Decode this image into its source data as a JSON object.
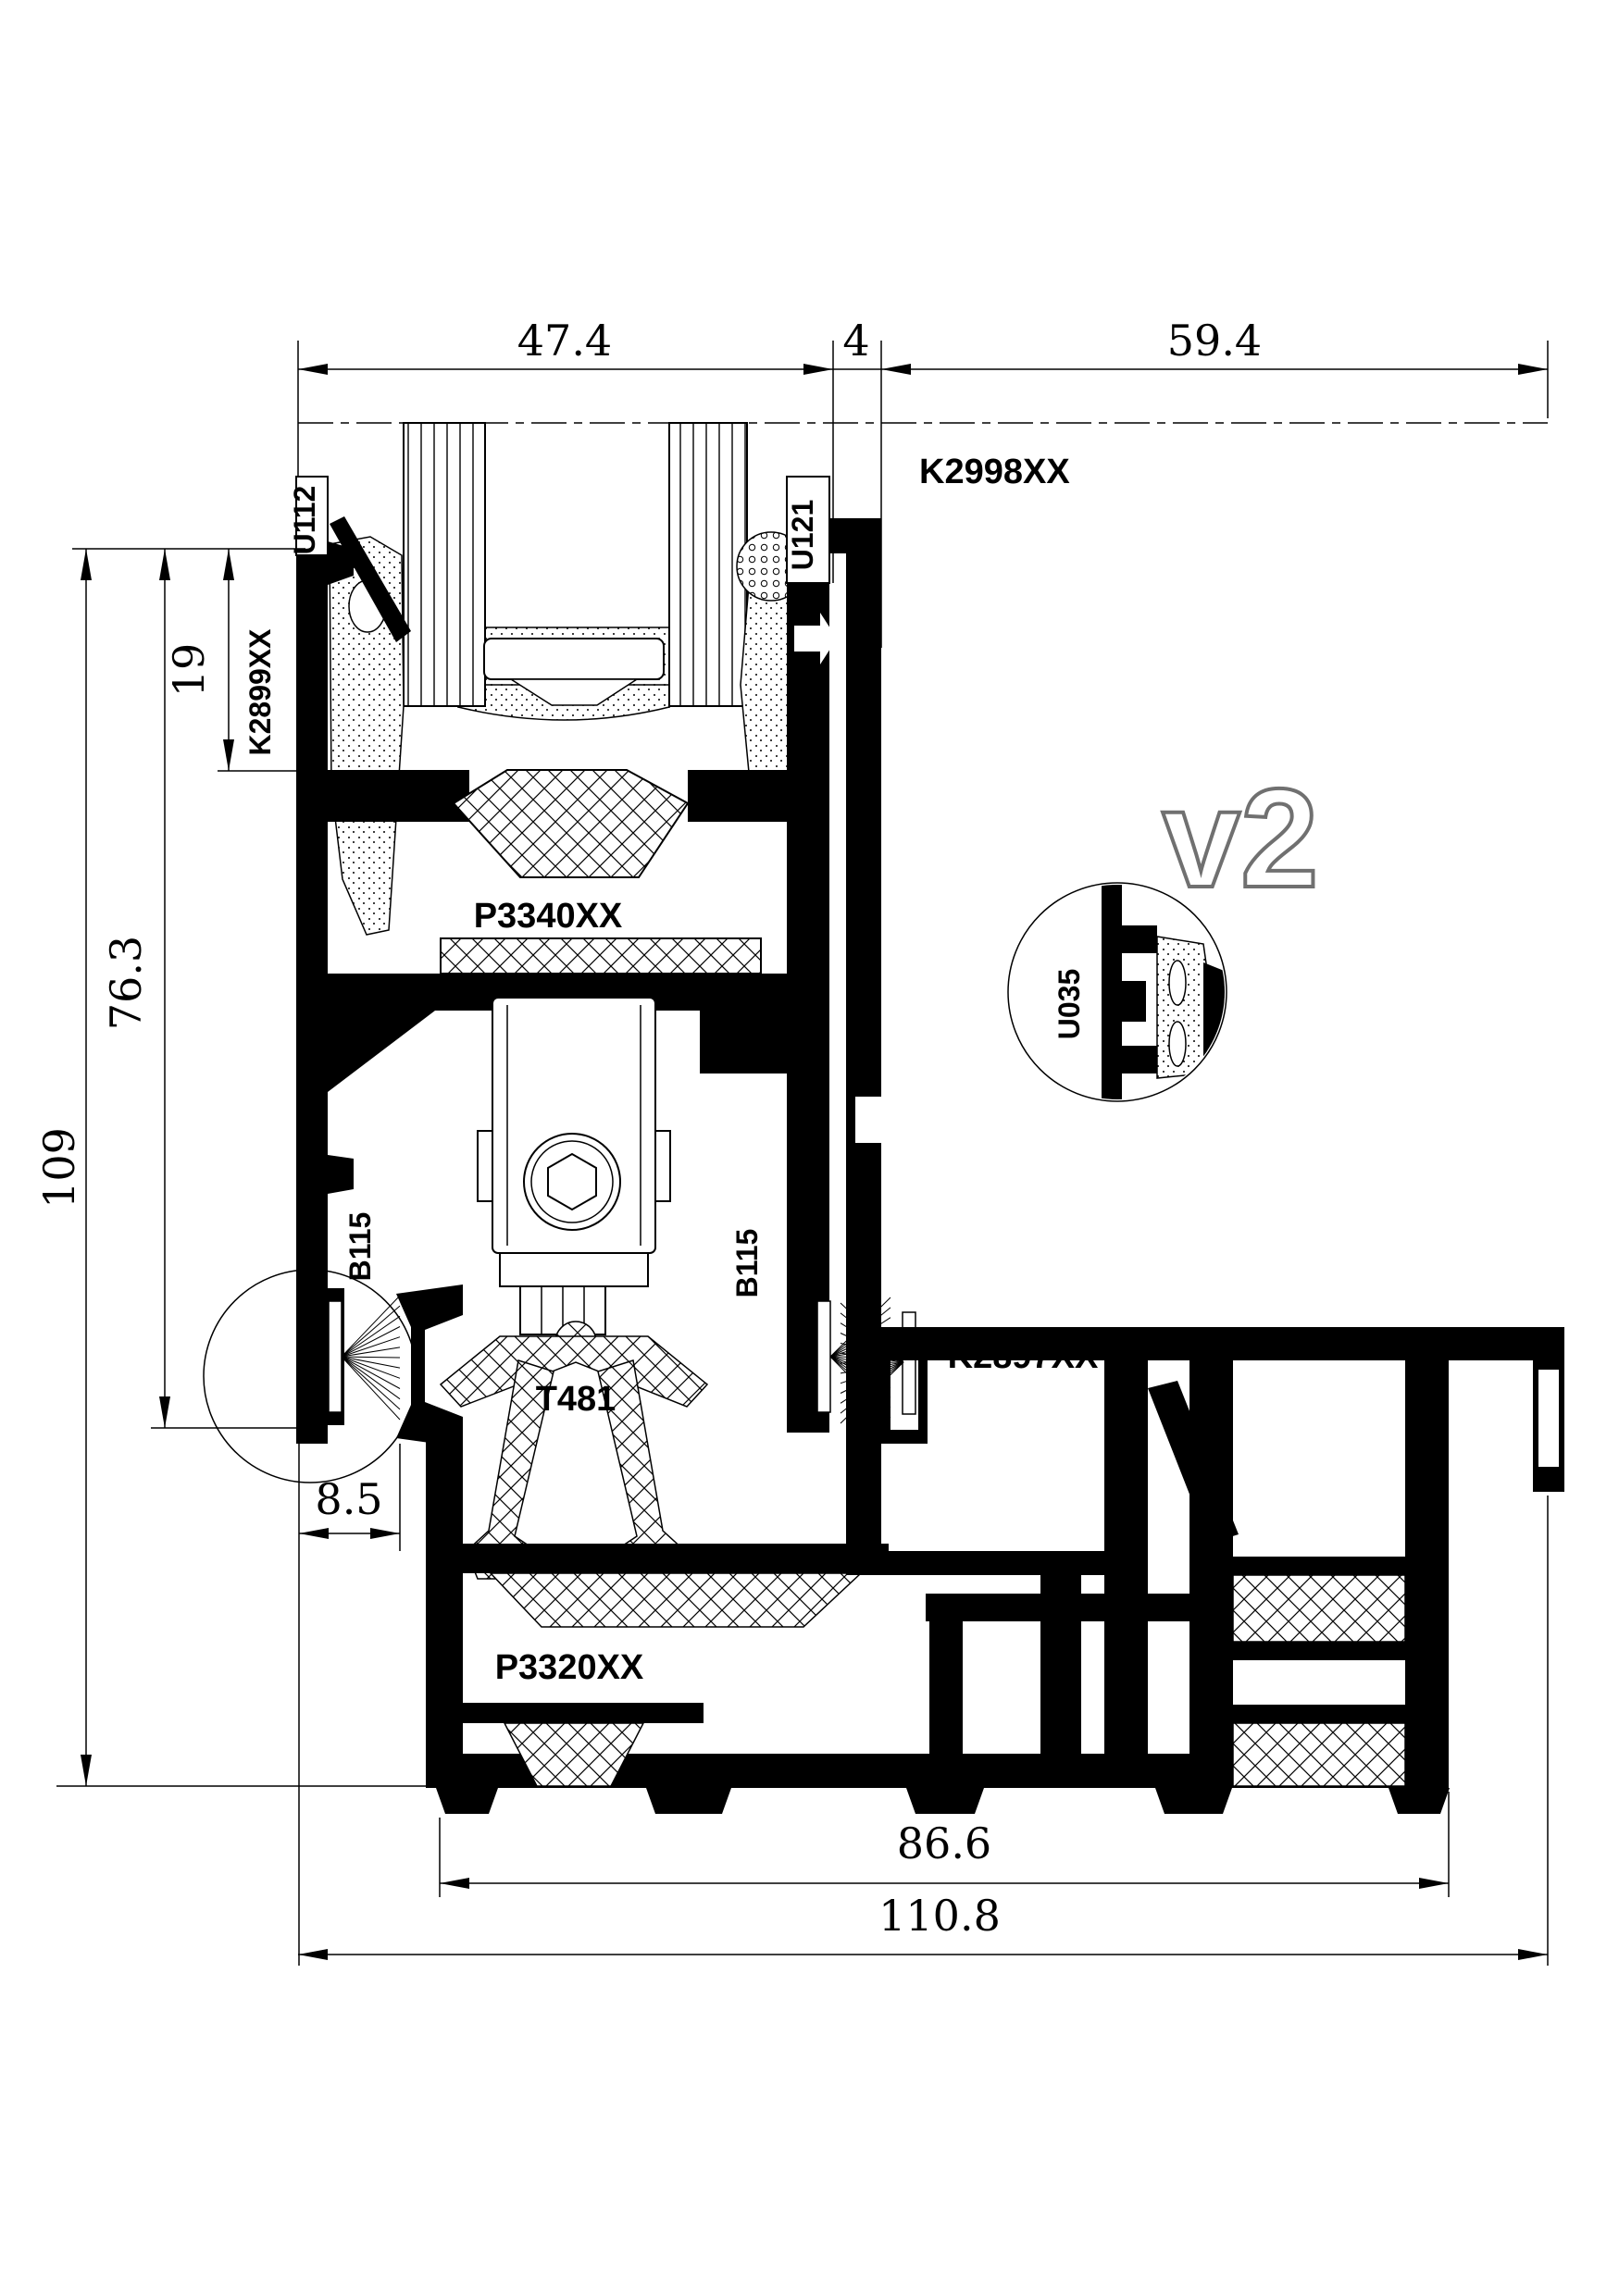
{
  "drawing_labels": {
    "u112": "U112",
    "u121": "U121",
    "k2998xx": "K2998XX",
    "k2899xx": "K2899XX",
    "p3340xx": "P3340XX",
    "u035": "U035",
    "b115_left": "B115",
    "b115_middle": "B115",
    "b115_right": "B115",
    "k2897xx": "K2897XX",
    "t481": "T481",
    "p3320xx": "P3320XX",
    "detail_version": "v2"
  },
  "dimensions_mm": {
    "top_sash_width": "47.4",
    "top_gap": "4",
    "top_frame_width": "59.4",
    "left_total_height": "109",
    "left_mid_height": "76.3",
    "left_top_height": "19",
    "offset": "8.5",
    "bottom_inner_width": "86.6",
    "bottom_total_width": "110.8"
  },
  "colors": {
    "ink": "#000000",
    "v2_outline": "#707070",
    "background": "#ffffff"
  }
}
